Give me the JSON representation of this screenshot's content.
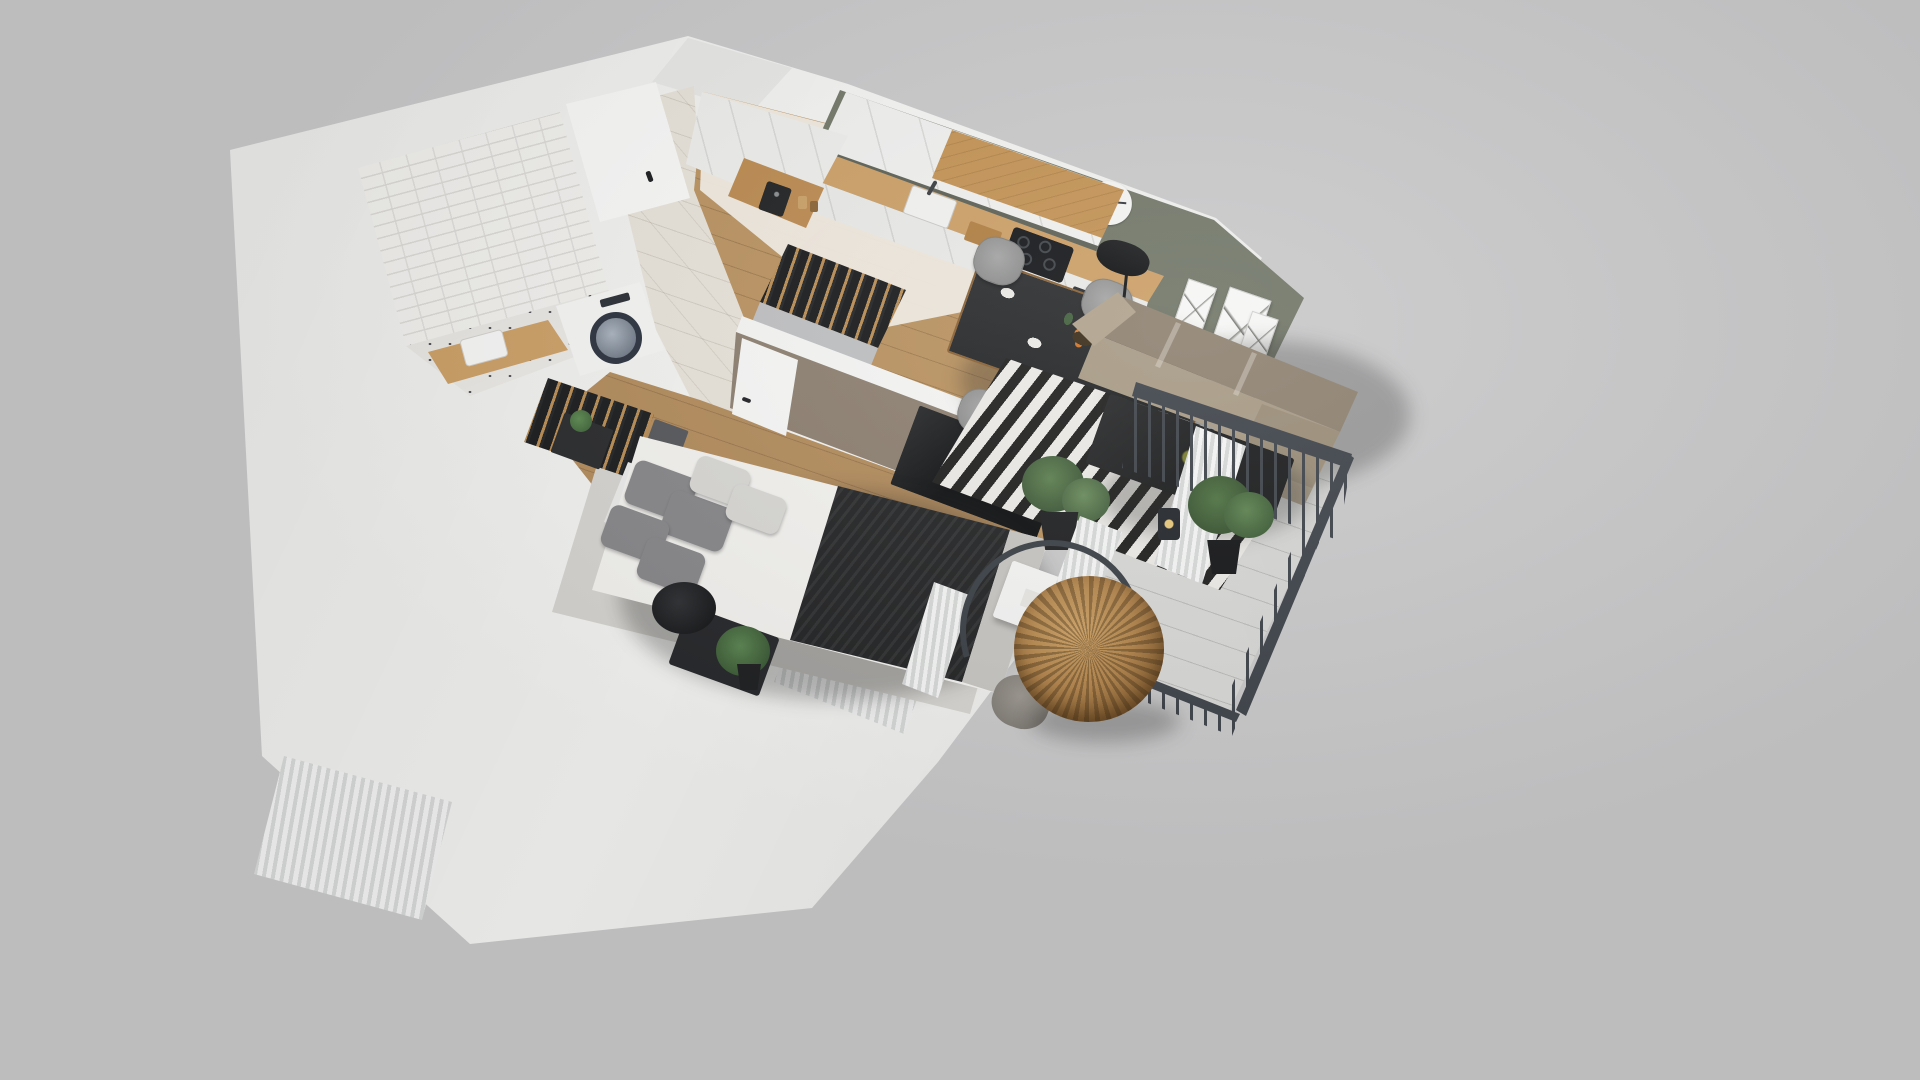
{
  "scene": {
    "description": "3D isometric dollhouse render of a one-bedroom apartment floor plan on a neutral gray background",
    "background": "#c9c9ca",
    "text_content": []
  },
  "palette": {
    "bg": "#c9c9ca",
    "wall": "#f4f4f2",
    "wall_shade": "#e7e7e5",
    "accent_olive": "#6e7366",
    "accent_taupe": "#8d8075",
    "wood_kitchen": "#c29254",
    "wood_counter": "#cc9f66",
    "wood_floor": "#b99260",
    "tile_floor": "#e7e2d9",
    "sofa": "#a79a85",
    "rug_dark": "#1f1f1e",
    "rug_light": "#eceae6",
    "rug_gray": "#d6d4d0",
    "bed_white": "#f3f2ef",
    "throw_black": "#232425",
    "rail": "#3e434a",
    "rattan": "#b0824a",
    "plant": "#46683f",
    "lamp_black": "#151617",
    "balcony_floor": "#d7d7d5"
  },
  "rooms": [
    {
      "id": "bathroom",
      "furniture": [
        "walk-in-shower",
        "tiled-wall",
        "washing-machine",
        "wood-vanity",
        "sink"
      ]
    },
    {
      "id": "hallway",
      "furniture": [
        "entrance-door",
        "open-coat-rack"
      ]
    },
    {
      "id": "kitchen",
      "furniture": [
        "tall-cabinets",
        "coffee-station",
        "wood-countertop",
        "sink",
        "induction-hob",
        "oven",
        "upper-cabinets",
        "cutting-board"
      ]
    },
    {
      "id": "living-dining",
      "furniture": [
        "dining-table",
        "dining-chairs",
        "floor-lamp",
        "corner-sofa",
        "coffee-table",
        "striped-rug",
        "wall-clock",
        "posters",
        "palm-plant",
        "curtains"
      ]
    },
    {
      "id": "bedroom",
      "furniture": [
        "open-wardrobe",
        "storage-boxes",
        "double-bed",
        "pillows",
        "throw-blanket",
        "nightstand",
        "bedside-lamp",
        "tv-wall",
        "tv",
        "desk-vanity",
        "makeup-mirror",
        "desk-chair",
        "plant"
      ]
    },
    {
      "id": "balcony",
      "furniture": [
        "metal-railing",
        "hanging-egg-chair",
        "lantern",
        "potted-plant"
      ]
    }
  ]
}
